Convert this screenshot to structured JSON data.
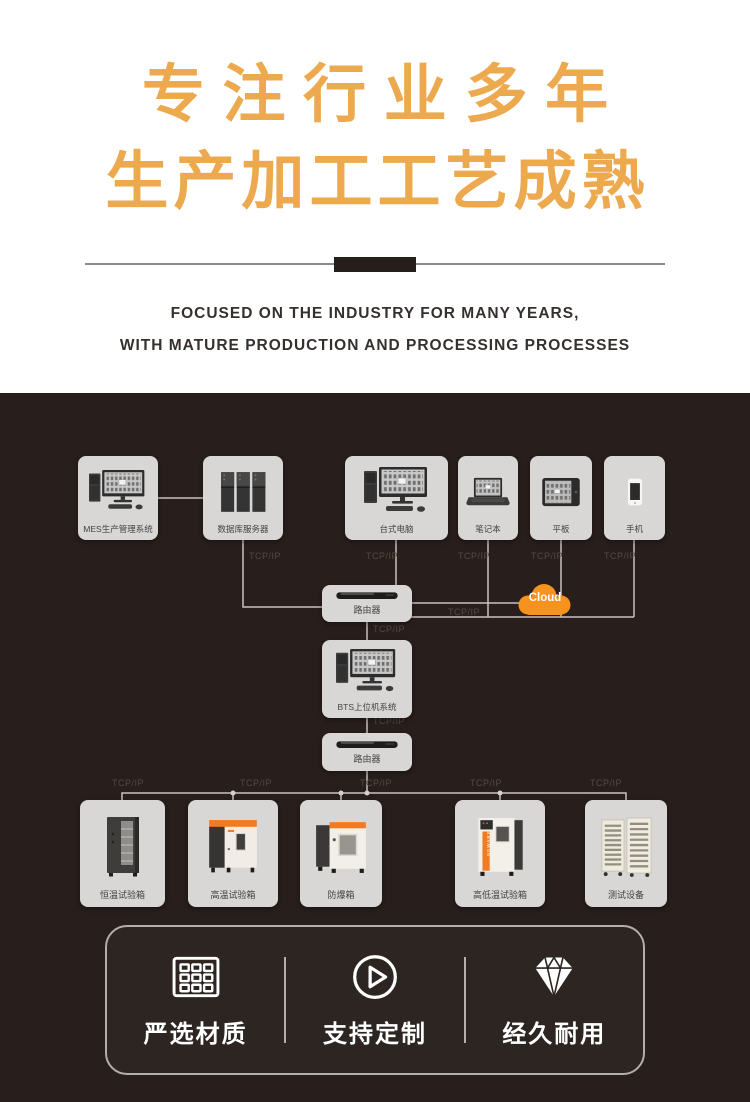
{
  "hero": {
    "title_line1": "专注行业多年",
    "title_line2": "生产加工工艺成熟",
    "subtitle_line1": "FOCUSED ON THE INDUSTRY FOR MANY YEARS,",
    "subtitle_line2": "WITH MATURE PRODUCTION AND PROCESSING PROCESSES"
  },
  "colors": {
    "title_gold": "#EDA94E",
    "dark_background": "#281E1B",
    "node_background": "#D8D7D5",
    "wire": "#C7C2BF",
    "cloud_orange": "#F6921E",
    "accent_orange": "#F07B25",
    "card_border": "#B3AEAB"
  },
  "diagram": {
    "tcp_label": "TCP/IP",
    "cloud": {
      "label": "Cloud",
      "icon": "cloud-icon"
    },
    "top_nodes": [
      {
        "label": "MES生产管理系统",
        "icon": "desktop-computer-icon"
      },
      {
        "label": "数据库服务器",
        "icon": "server-rack-icon"
      },
      {
        "label": "台式电脑",
        "icon": "desktop-computer-icon"
      },
      {
        "label": "笔记本",
        "icon": "laptop-icon"
      },
      {
        "label": "平板",
        "icon": "tablet-icon"
      },
      {
        "label": "手机",
        "icon": "smartphone-icon"
      }
    ],
    "middle_nodes": [
      {
        "label": "路由器",
        "icon": "router-icon"
      },
      {
        "label": "BTS上位机系统",
        "icon": "desktop-computer-icon"
      },
      {
        "label": "路由器",
        "icon": "router-icon"
      }
    ],
    "bottom_nodes": [
      {
        "label": "恒温试验箱",
        "icon": "constant-temp-chamber-icon"
      },
      {
        "label": "高温试验箱",
        "icon": "high-temp-chamber-icon"
      },
      {
        "label": "防爆箱",
        "icon": "explosion-proof-box-icon"
      },
      {
        "label": "高低温试验箱",
        "icon": "high-low-temp-chamber-icon",
        "brand": "NEWARE"
      },
      {
        "label": "测试设备",
        "icon": "test-rack-icon"
      }
    ]
  },
  "features": {
    "items": [
      {
        "label": "严选材质",
        "icon": "grid-icon"
      },
      {
        "label": "支持定制",
        "icon": "play-icon"
      },
      {
        "label": "经久耐用",
        "icon": "diamond-icon"
      }
    ]
  }
}
